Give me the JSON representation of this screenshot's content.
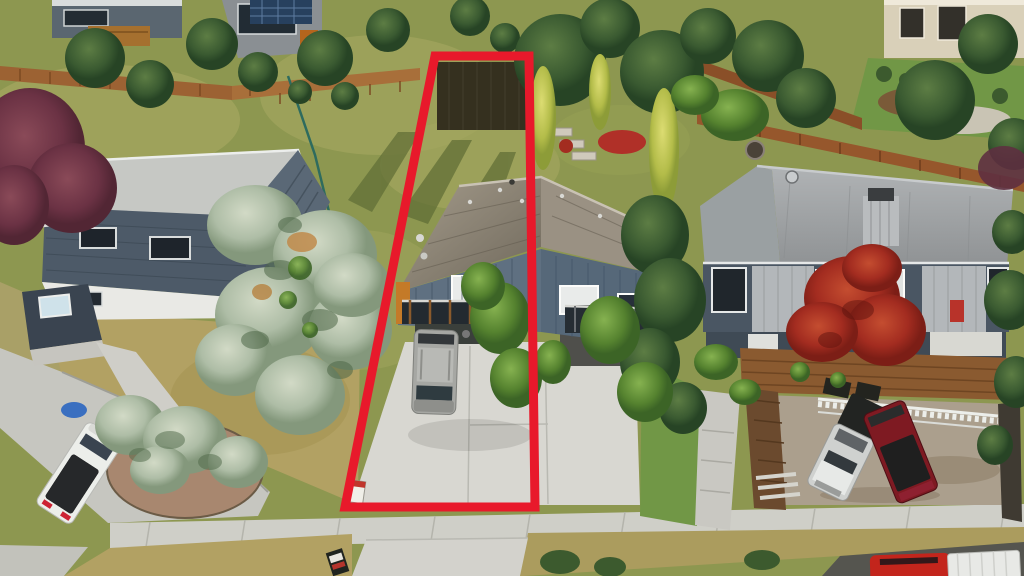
{
  "scene": {
    "subject": "aerial-drone-photo-residential-property-with-red-lot-boundary"
  },
  "boundary": {
    "points": "435,56 529,56 535,507 345,507",
    "color": "#e8192b",
    "stroke_width": 9
  },
  "colors": {
    "grass_olive": "#8d9750",
    "grass_dry_tan": "#b2a163",
    "lawn_green": "#719746",
    "street_gray": "#c6c6c0",
    "sidewalk_gray": "#cfcfc8",
    "driveway_concrete": "#d8d7d1",
    "asphalt_dark": "#55554f",
    "mulch_brown": "#a8876f",
    "gravel_tan": "#ab9f8d",
    "fence_brown": "#9c6233",
    "hedge_dark": "#35301f",
    "picket_white": "#eceeea"
  },
  "houses": {
    "left": {
      "roof_flat": "#c6c8c4",
      "roof_slope": "#5a6876",
      "siding": "#4d5a68",
      "lower_wall": "#e9e9e5"
    },
    "center_duplex": {
      "siding_left": "#5f7081",
      "siding_right": "#566879",
      "roof": "#8b8478",
      "deck_accent": "#c47a28"
    },
    "right": {
      "siding": "#4a5663",
      "panel_light": "#b3b7ba",
      "roof": "#a4a7a9",
      "deck_wood": "#8a5a30"
    }
  },
  "vehicles": {
    "white_pickup": {
      "label": "white pickup with black tonneau",
      "color": "#eceeea"
    },
    "silver_suv": {
      "label": "silver suv in subject driveway",
      "color": "#a6a7a3"
    },
    "silver_pickup": {
      "label": "silver pickup on parking pad",
      "color": "#cfd1cf"
    },
    "red_pickup": {
      "label": "dark red pickup on parking pad",
      "color": "#7e1a22"
    },
    "red_car": {
      "label": "red car parked on street",
      "color": "#c3251c"
    },
    "white_trailer": {
      "label": "white trailer on street",
      "color": "#e8e9e6"
    }
  },
  "vegetation": {
    "spruce_dark": "#31512f",
    "spruce_blue": "#b2c0aa",
    "maple_red": "#a52f24",
    "tree_purple": "#6d3547",
    "poplar_yellow": "#c0c653"
  }
}
